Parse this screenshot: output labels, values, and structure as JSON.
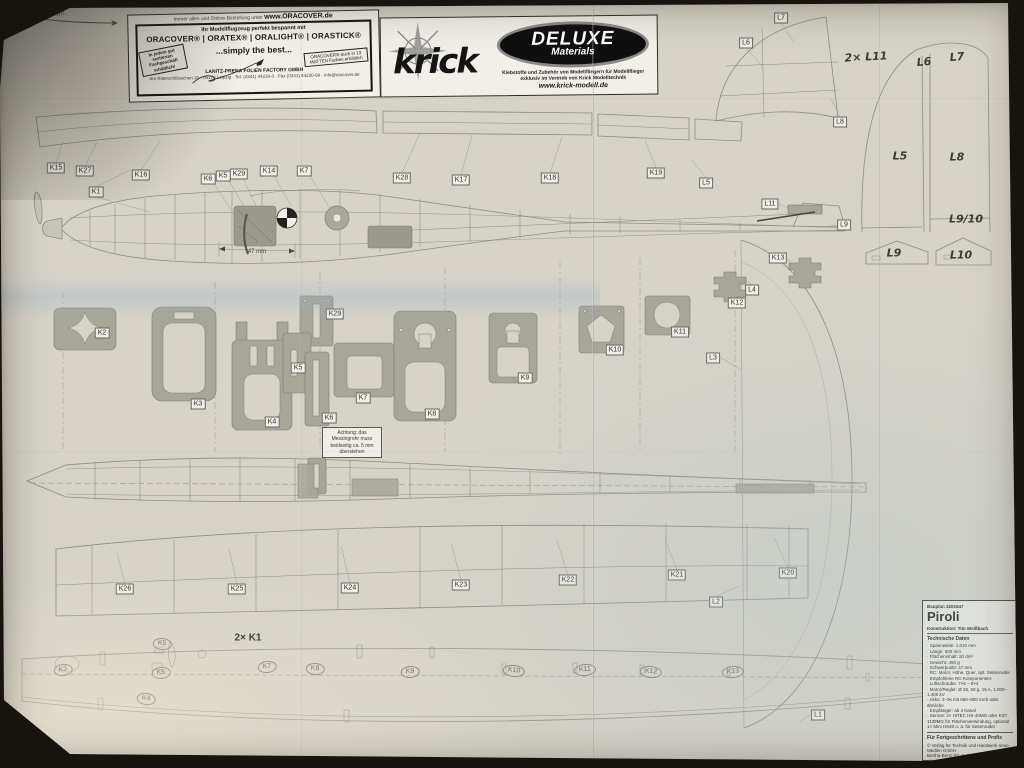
{
  "colors": {
    "table_surface": "#17130e",
    "paper": "#d7d3c9",
    "part_fill": "#a8a599",
    "line": "#8f8c82"
  },
  "scale_bar": {
    "label": "100 mm"
  },
  "ads": {
    "oracover": {
      "top_line": "Immer alles und Online-Bestellung unter",
      "top_url": "www.ORACOVER.de",
      "line1": "Ihr Modellflugzeug perfekt bespannt mit",
      "brands": "ORACOVER® | ORATEX® | ORALIGHT® | ORASTICK®",
      "slogan": "...simply the best...",
      "badge_left": "In jedem gut sortierten Fachgeschäft erhältlich!",
      "badge_right": "ORACOVER® auch in 13 MATTEN Farben erhältlich",
      "company": "LANITZ-PRENA FOLIEN FACTORY GMBH",
      "address": "Am Ritterschlösschen 20 · 04179 Leipzig · Tel. (0341) 44230-0 · Fax (0341) 44230-99 · info@oracover.de"
    },
    "krick": {
      "brand": "krick",
      "deluxe_line1": "DELUXE",
      "deluxe_line2": "Materials",
      "line1": "Klebstoffe und Zubehör von Modellfliegern für Modellflieger",
      "line2": "exklusiv im Vertrieb von Krick Modelltechnik",
      "url": "www.krick-modell.de"
    }
  },
  "annotations": {
    "wing_quantity": "2× K1",
    "cg_dimension": "47 mm"
  },
  "note_box": {
    "text": "Achtung: das Messingrohr muss beidseitig ca. 5 mm überstehen"
  },
  "labels": {
    "boxed": [
      {
        "text": "K15",
        "x": 56,
        "y": 168
      },
      {
        "text": "K27",
        "x": 85,
        "y": 171
      },
      {
        "text": "K16",
        "x": 141,
        "y": 175
      },
      {
        "text": "K1",
        "x": 96,
        "y": 192
      },
      {
        "text": "K6",
        "x": 208,
        "y": 179
      },
      {
        "text": "K5",
        "x": 223,
        "y": 176
      },
      {
        "text": "K29",
        "x": 239,
        "y": 174
      },
      {
        "text": "K14",
        "x": 269,
        "y": 171
      },
      {
        "text": "K7",
        "x": 304,
        "y": 171
      },
      {
        "text": "K28",
        "x": 402,
        "y": 178
      },
      {
        "text": "K17",
        "x": 461,
        "y": 180
      },
      {
        "text": "K18",
        "x": 550,
        "y": 178
      },
      {
        "text": "K19",
        "x": 656,
        "y": 173
      },
      {
        "text": "L5",
        "x": 706,
        "y": 183
      },
      {
        "text": "L7",
        "x": 781,
        "y": 18
      },
      {
        "text": "L6",
        "x": 746,
        "y": 43
      },
      {
        "text": "L8",
        "x": 840,
        "y": 122
      },
      {
        "text": "L11",
        "x": 770,
        "y": 204
      },
      {
        "text": "L9",
        "x": 844,
        "y": 225
      },
      {
        "text": "K13",
        "x": 778,
        "y": 258
      },
      {
        "text": "L4",
        "x": 752,
        "y": 290
      },
      {
        "text": "K12",
        "x": 737,
        "y": 303
      },
      {
        "text": "K2",
        "x": 102,
        "y": 333
      },
      {
        "text": "K3",
        "x": 198,
        "y": 404
      },
      {
        "text": "K4",
        "x": 272,
        "y": 422
      },
      {
        "text": "K29",
        "x": 335,
        "y": 314
      },
      {
        "text": "K5",
        "x": 298,
        "y": 368
      },
      {
        "text": "K6",
        "x": 329,
        "y": 418
      },
      {
        "text": "K7",
        "x": 363,
        "y": 398
      },
      {
        "text": "K8",
        "x": 432,
        "y": 414
      },
      {
        "text": "K9",
        "x": 525,
        "y": 378
      },
      {
        "text": "K10",
        "x": 615,
        "y": 350
      },
      {
        "text": "K11",
        "x": 680,
        "y": 332
      },
      {
        "text": "L3",
        "x": 713,
        "y": 358
      },
      {
        "text": "K26",
        "x": 125,
        "y": 589
      },
      {
        "text": "K25",
        "x": 237,
        "y": 589
      },
      {
        "text": "K24",
        "x": 350,
        "y": 588
      },
      {
        "text": "K23",
        "x": 461,
        "y": 585
      },
      {
        "text": "K22",
        "x": 568,
        "y": 580
      },
      {
        "text": "K21",
        "x": 677,
        "y": 575
      },
      {
        "text": "K20",
        "x": 788,
        "y": 573
      },
      {
        "text": "L2",
        "x": 716,
        "y": 602
      },
      {
        "text": "L1",
        "x": 818,
        "y": 715
      }
    ],
    "marker": [
      {
        "text": "2× L11",
        "x": 866,
        "y": 57,
        "r": -3
      },
      {
        "text": "L6",
        "x": 924,
        "y": 62,
        "r": -5
      },
      {
        "text": "L7",
        "x": 957,
        "y": 57,
        "r": -5
      },
      {
        "text": "L5",
        "x": 900,
        "y": 156
      },
      {
        "text": "L8",
        "x": 957,
        "y": 157
      },
      {
        "text": "L9/10",
        "x": 966,
        "y": 219
      },
      {
        "text": "L9",
        "x": 894,
        "y": 253
      },
      {
        "text": "L10",
        "x": 961,
        "y": 255
      }
    ],
    "pencil": [
      {
        "text": "K3",
        "x": 63,
        "y": 670,
        "r": -8
      },
      {
        "text": "K5",
        "x": 162,
        "y": 644,
        "r": 5
      },
      {
        "text": "K6",
        "x": 161,
        "y": 673,
        "r": -5
      },
      {
        "text": "K4",
        "x": 146,
        "y": 699,
        "r": 8
      },
      {
        "text": "K7",
        "x": 267,
        "y": 667,
        "r": -6
      },
      {
        "text": "K8",
        "x": 315,
        "y": 669,
        "r": 4
      },
      {
        "text": "K9",
        "x": 410,
        "y": 672,
        "r": -4
      },
      {
        "text": "K10",
        "x": 514,
        "y": 671,
        "r": 6
      },
      {
        "text": "K11",
        "x": 585,
        "y": 670,
        "r": -5
      },
      {
        "text": "K12",
        "x": 651,
        "y": 672,
        "r": 5
      },
      {
        "text": "K13",
        "x": 733,
        "y": 672,
        "r": -6
      }
    ]
  },
  "title_block": {
    "plan_no": "Bauplan 3201547",
    "title": "Piroli",
    "construction": "Konstruktion: Tim Weißbach",
    "section": "Technische Daten",
    "tech_items": [
      "Spannweite: 1.010 mm",
      "Länge: 600 mm",
      "Flächeninhalt: 20 dm²",
      "Gewicht: 490 g",
      "Schwerpunkt: 47 mm",
      "RC: Motor, Höhe, Quer, opt. Seitenruder",
      "Empfohlene RC-Komponenten:",
      "Luftschraube: 7×6 – 8×4",
      "Motor/Regler: Ø 28, 50 g, 15 A, 1.000–1.400 kV",
      "Akku: 2–3s mit 690–800 mAh oder ähnliche",
      "Empfänger: ab 4 Kanal",
      "Servos: 2× HiTEC HS-40MG oder KST 1139MG für Flächenverwindung, optional 1× Mini HS40 o. ä. für Seitenruder"
    ],
    "skill": "Für Fortgeschrittene und Profis",
    "publisher": "© Verlag für Technik und Handwerk neue Medien GmbH",
    "address": "Bertha-Benz-Str. 7, 76532 Baden-Baden",
    "sheet": "Blatt 1/2",
    "date": "FMT 08/2022"
  }
}
